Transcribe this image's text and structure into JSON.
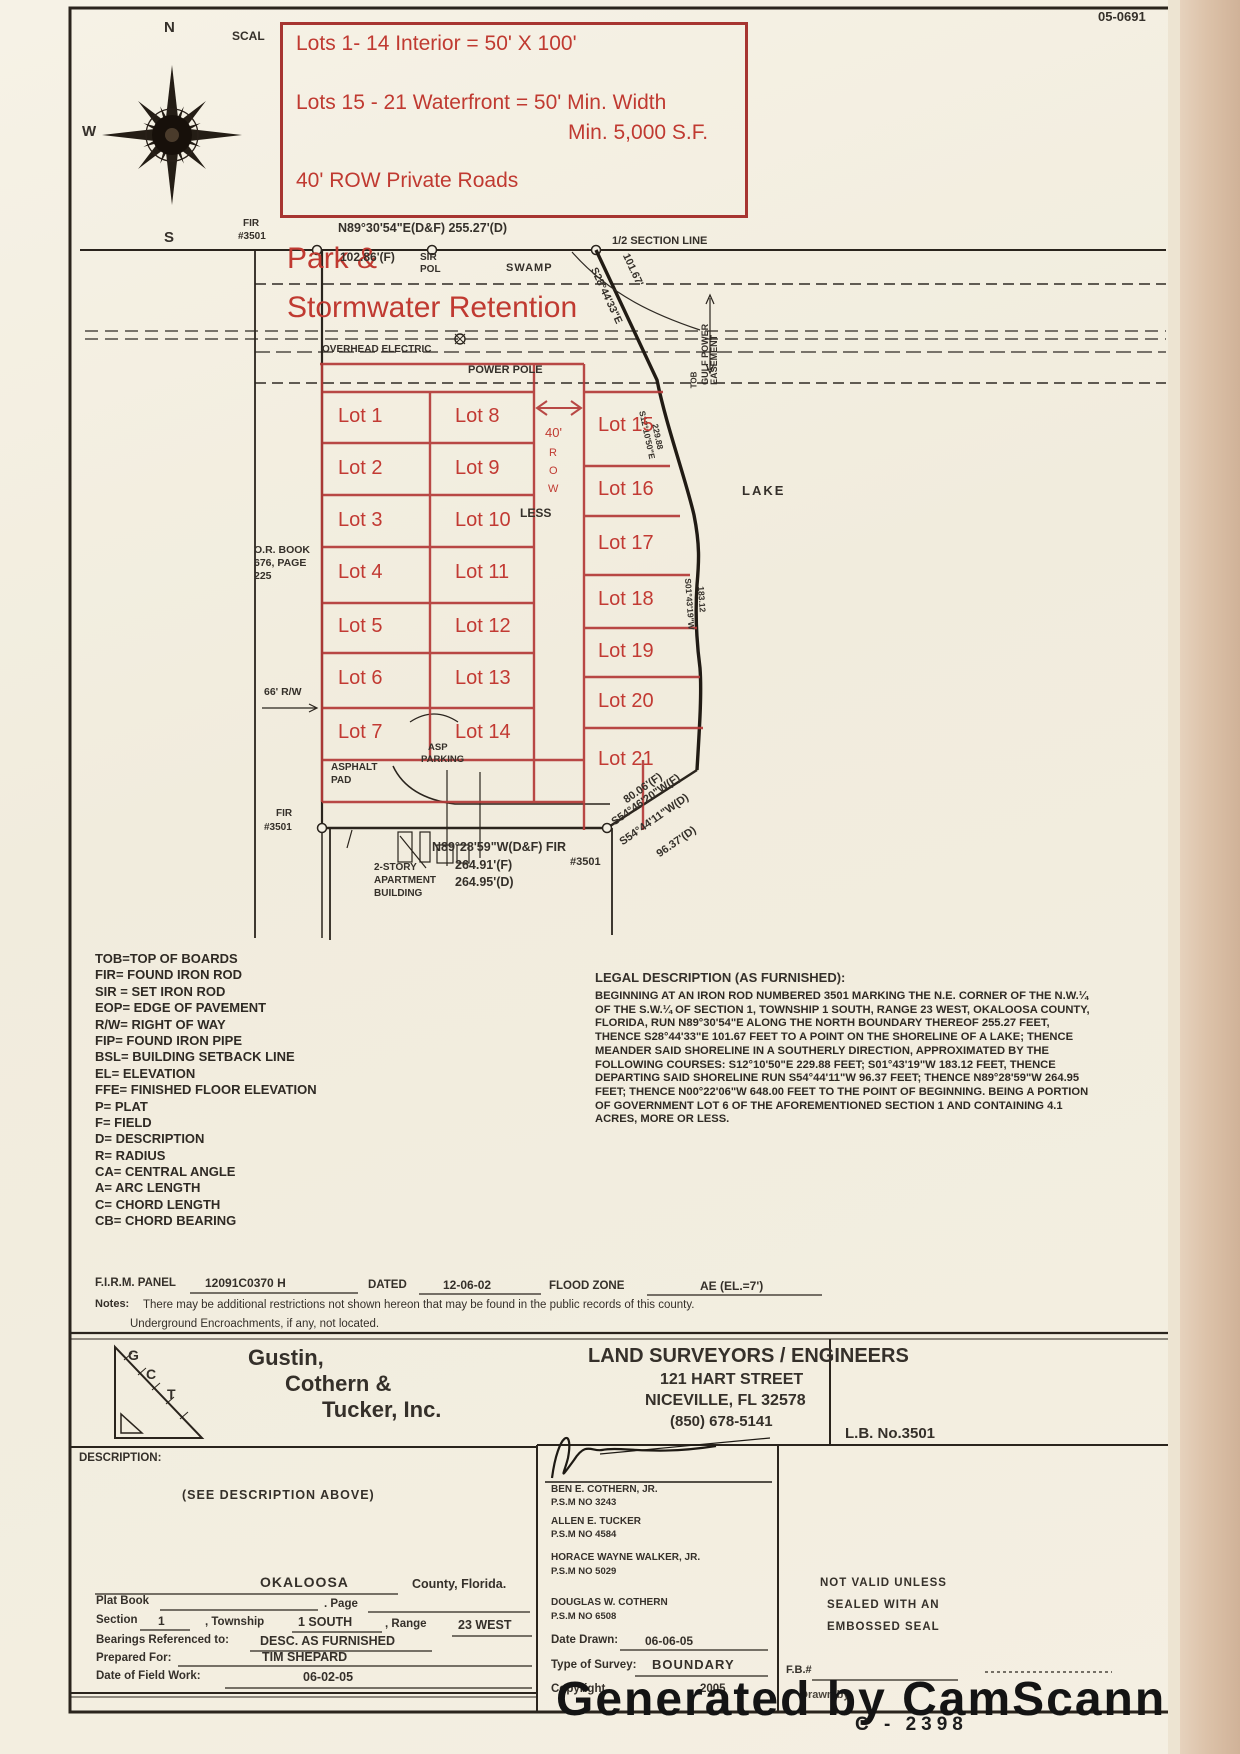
{
  "page": {
    "doc_number": "05-0691",
    "footer_number": "C -  2398",
    "camscanner": "Generated by CamScanner"
  },
  "annotation_box": {
    "line1": "Lots 1- 14 Interior = 50' X 100'",
    "line2": "Lots 15 - 21 Waterfront = 50' Min. Width",
    "line3": "Min. 5,000 S.F.",
    "line4": "40' ROW Private Roads",
    "park_line1": "Park &",
    "park_line2": "Stormwater Retention",
    "red_color": "#c03a31"
  },
  "compass": {
    "north": "N",
    "west": "W",
    "south": "S",
    "scale_label": "SCAL"
  },
  "plat": {
    "fir_top": "FIR",
    "fir_top_num": "#3501",
    "north_bearing": "N89°30'54\"E(D&F)  255.27'(D)",
    "half_section": "1/2 SECTION LINE",
    "dist_102": "102.86'(F)",
    "sir": "SIR",
    "pol": "POL",
    "swamp": "SWAMP",
    "s28": "S28°44'33\"E",
    "d101": "101.67'",
    "overhead": "OVERHEAD ELECTRIC",
    "power_pole": "POWER POLE",
    "gulf1": "GULF POWER",
    "gulf2": "EASEMENT",
    "tob": "TOB",
    "lake": "LAKE",
    "row_40": "40'",
    "row_r": "R",
    "row_o": "O",
    "row_w": "W",
    "less": "LESS",
    "s12": "S12°10'50\"E",
    "d229": "229.88",
    "s01": "S01°43'19\"W",
    "d183": "183.12",
    "or_book1": "O.R. BOOK",
    "or_book2": "676, PAGE",
    "or_book3": "225",
    "rw66": "66' R/W",
    "fir_sw": "FIR",
    "fir_sw_num": "#3501",
    "south_bearing": "N89°28'59\"W(D&F) FIR",
    "fir_se_num": "#3501",
    "d264f": "264.91'(F)",
    "d264d": "264.95'(D)",
    "apt1": "2-STORY",
    "apt2": "APARTMENT",
    "apt3": "BUILDING",
    "asphalt1": "ASPHALT",
    "asphalt2": "PAD",
    "asp1": "ASP",
    "asp2": "PARKING",
    "d80": "80.06'(F)",
    "s54f": "S54°46'20\"W(F)",
    "s54d": "S54°44'11\"W(D)",
    "d96": "96.37'(D)"
  },
  "lots": [
    {
      "label": "Lot 1"
    },
    {
      "label": "Lot 2"
    },
    {
      "label": "Lot 3"
    },
    {
      "label": "Lot 4"
    },
    {
      "label": "Lot 5"
    },
    {
      "label": "Lot 6"
    },
    {
      "label": "Lot 7"
    },
    {
      "label": "Lot 8"
    },
    {
      "label": "Lot 9"
    },
    {
      "label": "Lot 10"
    },
    {
      "label": "Lot 11"
    },
    {
      "label": "Lot 12"
    },
    {
      "label": "Lot 13"
    },
    {
      "label": "Lot 14"
    },
    {
      "label": "Lot 15"
    },
    {
      "label": "Lot 16"
    },
    {
      "label": "Lot 17"
    },
    {
      "label": "Lot 18"
    },
    {
      "label": "Lot 19"
    },
    {
      "label": "Lot 20"
    },
    {
      "label": "Lot 21"
    }
  ],
  "legend": {
    "items": [
      "TOB=TOP OF BOARDS",
      "FIR= FOUND IRON ROD",
      "SIR = SET IRON ROD",
      "EOP= EDGE OF PAVEMENT",
      "R/W= RIGHT OF WAY",
      "FIP= FOUND IRON PIPE",
      "BSL= BUILDING SETBACK LINE",
      "EL= ELEVATION",
      "FFE= FINISHED FLOOR ELEVATION",
      "P= PLAT",
      "F= FIELD",
      "D= DESCRIPTION",
      "R= RADIUS",
      "CA= CENTRAL ANGLE",
      "A= ARC LENGTH",
      "C= CHORD LENGTH",
      "CB= CHORD BEARING"
    ]
  },
  "legal": {
    "title": "LEGAL DESCRIPTION (AS FURNISHED):",
    "body": "BEGINNING AT AN IRON ROD NUMBERED 3501 MARKING THE N.E. CORNER OF THE N.W.¼\nOF THE S.W.¼ OF SECTION 1, TOWNSHIP 1 SOUTH, RANGE 23 WEST, OKALOOSA COUNTY,\nFLORIDA, RUN N89°30'54\"E ALONG THE NORTH BOUNDARY THEREOF 255.27 FEET,\nTHENCE S28°44'33\"E 101.67 FEET TO A POINT ON THE SHORELINE OF A LAKE; THENCE\nMEANDER SAID SHORELINE IN A SOUTHERLY DIRECTION, APPROXIMATED BY THE\nFOLLOWING COURSES: S12°10'50\"E 229.88 FEET; S01°43'19\"W 183.12 FEET, THENCE\nDEPARTING SAID SHORELINE RUN S54°44'11\"W 96.37 FEET; THENCE N89°28'59\"W 264.95\nFEET; THENCE N00°22'06\"W 648.00 FEET TO THE POINT OF BEGINNING. BEING A PORTION\nOF GOVERNMENT LOT 6 OF THE AFOREMENTIONED SECTION 1 AND CONTAINING 4.1\nACRES, MORE OR LESS."
  },
  "firm": {
    "label": "F.I.R.M. PANEL",
    "panel": "12091C0370 H",
    "dated_label": "DATED",
    "dated": "12-06-02",
    "zone_label": "FLOOD ZONE",
    "zone": "AE (EL.=7')"
  },
  "notes": {
    "label": "Notes:",
    "line1": "There may be additional restrictions not shown hereon that may be found in the public records of this county.",
    "line2": "Underground Encroachments, if any, not located."
  },
  "company": {
    "logo_g": "G",
    "logo_c": "C",
    "logo_t": "T",
    "name1": "Gustin,",
    "name2": "Cothern &",
    "name3": "Tucker, Inc.",
    "title": "LAND SURVEYORS / ENGINEERS",
    "street": "121 HART STREET",
    "city": "NICEVILLE, FL  32578",
    "phone": "(850) 678-5141",
    "lb": "L.B. No.3501"
  },
  "description_box": {
    "label": "DESCRIPTION:",
    "content": "(SEE DESCRIPTION ABOVE)"
  },
  "form": {
    "county": "OKALOOSA",
    "county_suffix": "County, Florida.",
    "plat_book_label": "Plat Book",
    "page_label": ". Page",
    "section_label": "Section",
    "section": "1",
    "township_label": ", Township",
    "township": "1 SOUTH",
    "range_label": ", Range",
    "range": "23 WEST",
    "bearings_label": "Bearings Referenced to:",
    "bearings": "DESC. AS FURNISHED",
    "prepared_label": "Prepared For:",
    "prepared": "TIM SHEPARD",
    "fieldwork_label": "Date of Field Work:",
    "fieldwork": "06-02-05"
  },
  "signers": [
    {
      "name": "BEN E. COTHERN, JR.",
      "num": "P.S.M NO 3243"
    },
    {
      "name": "ALLEN E. TUCKER",
      "num": "P.S.M NO 4584"
    },
    {
      "name": "HORACE WAYNE WALKER, JR.",
      "num": "P.S.M NO 5029"
    },
    {
      "name": "DOUGLAS W. COTHERN",
      "num": "P.S.M NO 6508"
    }
  ],
  "sign_meta": {
    "date_label": "Date Drawn:",
    "date": "06-06-05",
    "type_label": "Type of Survey:",
    "type": "BOUNDARY",
    "copyright_label": "Copyright",
    "copyright_year": "2005"
  },
  "validity": {
    "l1": "NOT VALID UNLESS",
    "l2": "SEALED WITH AN",
    "l3": "EMBOSSED SEAL",
    "fb": "F.B.#",
    "drawn_by": "Drawn by"
  }
}
